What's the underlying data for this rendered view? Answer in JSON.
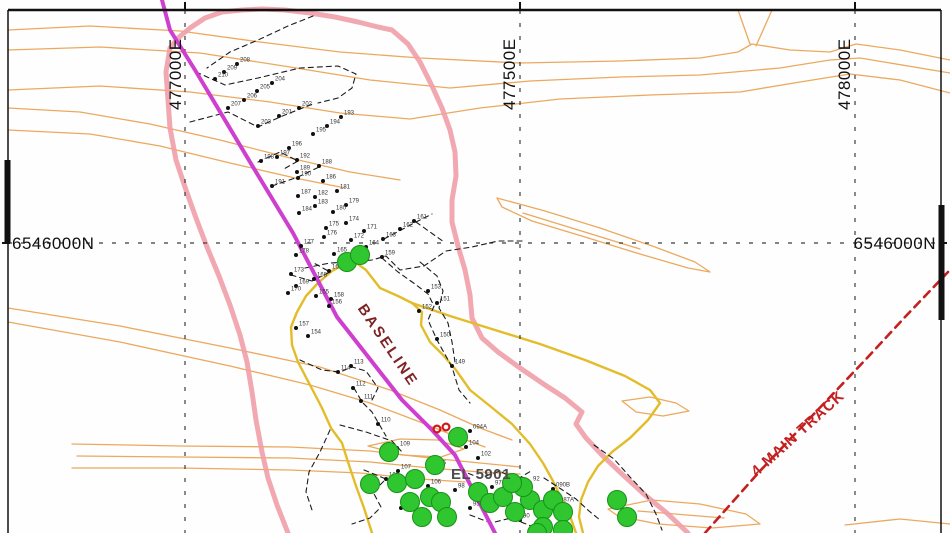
{
  "map": {
    "grid": {
      "eastings": [
        {
          "label": "477000E",
          "x": 185
        },
        {
          "label": "477500E",
          "x": 520
        },
        {
          "label": "478000E",
          "x": 855
        }
      ],
      "northings": [
        {
          "label": "6546000N",
          "y": 243
        }
      ],
      "northing_left_label": "6546000N",
      "northing_right_label": "6546000N",
      "line_color": "#3c3c3c"
    },
    "annotations": {
      "baseline_label": "BASELINE",
      "tenement_label": "EL 5901",
      "track_label": "4  MAIN TRACK"
    },
    "layers": {
      "contours": {
        "color": "#eba95f",
        "width": 1.3,
        "paths": [
          "M8,30 L90,26 L180,31 L260,42 L340,52 L420,58 L520,63 L620,61 L700,58 L738,52 L752,44 L790,50 L830,52 L856,44 L900,50 L950,60",
          "M738,10 L750,44",
          "M772,10 L756,46",
          "M8,50 L100,47 L200,53 L290,67 L370,80 L450,88 L530,81 L620,77 L700,75 L780,68 L830,60 L860,58 L950,73",
          "M8,90 L100,86 L190,92 L270,102 L340,113 L410,119 L480,108 L560,99 L650,95 L740,92 L800,82 L850,74 L900,80 L950,93",
          "M8,108 L80,112 L150,124 L220,140 L290,158 L350,172 L400,180",
          "M8,130 L90,134 L160,146 L230,163 L295,178 L345,188",
          "M8,308 L120,326 L230,348 L320,367 L390,390 L440,410 L480,428 L512,440",
          "M8,322 L120,342 L230,366 L310,385 L370,403 L420,422 L455,436 L485,447",
          "M72,444 L180,446 L290,447 L370,451 L430,458 L470,462 L520,467",
          "M77,456 L180,457 L290,458 L370,462 L430,468 L480,472 L520,474",
          "M72,468 L180,468 L290,470 L360,473 L420,479 L465,482",
          "M368,446 L400,439 L438,440 L464,449 L441,457 L402,455 Z",
          "M497,198 L545,211 L600,228 L655,247 L695,262 L710,272 L688,268 L640,254 L585,237 L532,221 L502,207 Z",
          "M523,213 L640,249",
          "M622,401 L650,397 L676,403 L689,411 L663,416 L636,412 Z",
          "M608,509 L652,500 L700,504 L746,514 L760,524 L712,528 L658,524 L618,516 Z",
          "M638,511 L724,518",
          "M845,525 L900,519 L950,524"
        ]
      },
      "pink_outline": {
        "color": "#ef9fa8",
        "width": 5,
        "paths": [
          "M288,533 L277,505 L268,478 L262,452 L256,420 L252,392 L247,362 L240,335 L230,305 L219,276 L207,247 L196,218 L186,190 L176,160 L170,128 L168,100 L166,72 L170,48 L178,38 L190,28 L205,18 L222,12 L242,10 L262,9 L285,10 L310,13 L335,17 L358,22 L378,27 L392,30 L408,44 L420,62 L432,86 L442,108 L450,130 L455,152 L456,176 L452,200 L452,222 L458,246 L465,270 L470,295 L472,318 L482,338 L498,352 L520,368 L545,385 L565,398 L582,412 L576,424 L586,438 L602,455 L622,474 L645,495 L668,514 L688,533"
        ]
      },
      "tenement": {
        "color": "#e3bc2a",
        "width": 2.4,
        "paths": [
          "M372,533 L364,508 L356,486 L348,462 L342,443 L331,428 L322,408 L310,385 L298,362 L292,345 L291,327 L297,312 L306,296 L318,283 L332,271 L345,264 L355,262 L366,270 L380,288 L398,296 L412,303 L422,312 L421,325 L430,342 L443,355 L456,370 L470,390 L490,406 L512,424 L530,444 L543,463 L553,481 L562,500 L570,516 L576,533",
          "M412,303 L450,316 L495,330 L540,344 L585,360 L625,376 L650,390 L660,403 L648,420 L630,438 L612,452 L598,466 L588,482 L581,500 L579,517 L583,533"
        ]
      },
      "baseline": {
        "color": "#cf3fcf",
        "width": 4,
        "paths": [
          "M162,0 L170,30 L195,70 L213,100 L253,167 L293,233 L337,317 L402,400 L432,430 L455,455 L495,533"
        ]
      },
      "track": {
        "color": "#c42020",
        "width": 2.6,
        "dash": "8 6",
        "paths": [
          "M705,533 L760,471 L812,416 L868,357 L905,317 L948,272"
        ]
      },
      "traverses": {
        "color": "#1c1c1c",
        "width": 1.1,
        "dash": "5 4",
        "paths": [
          "M313,16 L288,26 L258,40 L230,52 L207,68",
          "M196,72 L225,85 L258,78 L300,68 L338,66 L356,74 L352,88 L338,98 L318,103",
          "M190,122 L228,112 L258,127 L280,117 L300,109 L313,104",
          "M258,162 L280,152 L298,161 L282,170",
          "M272,186 L298,177 L319,167",
          "M305,268 L330,263 L352,262 L372,260 L386,256 L400,270 L424,266 L446,251 L472,247 L498,241 L524,241",
          "M384,239 L401,230 L416,222 L432,214",
          "M416,222 L444,242",
          "M382,258 L398,272 L415,284 L428,294 L434,306 L428,320 L437,340 L452,367 L459,390 L470,403",
          "M291,275 L312,281 L330,272 L312,262",
          "M300,360 L322,370 L340,372 L352,367 L366,371 L378,388 L372,400",
          "M354,388 L362,402 L372,412 L379,424 L386,436",
          "M330,430 L320,452 L309,472 L306,492 L312,510",
          "M340,425 L366,432 L392,441 L402,452",
          "M420,262 L437,276 L443,291 L439,308 L448,323 L452,342 L455,362",
          "M460,470 L480,478 L500,471 L516,480 L531,471",
          "M544,478 L561,489 L576,499 L589,511 L600,520",
          "M594,445 L614,459 L630,477 L646,494 L656,514 L662,530",
          "M470,515 L491,523 L511,518 L531,526 L549,532",
          "M364,470 L386,479 L373,492 L381,507 L370,518 L352,524"
        ]
      },
      "stations": {
        "dot_color": "#111111",
        "label_color": "#333333",
        "points": [
          {
            "id": "208",
            "x": 237,
            "y": 64
          },
          {
            "id": "209",
            "x": 224,
            "y": 72
          },
          {
            "id": "210",
            "x": 215,
            "y": 79
          },
          {
            "id": "204",
            "x": 272,
            "y": 83
          },
          {
            "id": "205",
            "x": 257,
            "y": 91
          },
          {
            "id": "206",
            "x": 244,
            "y": 100
          },
          {
            "id": "207",
            "x": 228,
            "y": 108
          },
          {
            "id": "202",
            "x": 299,
            "y": 108
          },
          {
            "id": "201",
            "x": 279,
            "y": 116
          },
          {
            "id": "203",
            "x": 258,
            "y": 126
          },
          {
            "id": "193",
            "x": 341,
            "y": 117
          },
          {
            "id": "194",
            "x": 327,
            "y": 126
          },
          {
            "id": "195",
            "x": 313,
            "y": 134
          },
          {
            "id": "196",
            "x": 289,
            "y": 148
          },
          {
            "id": "197",
            "x": 277,
            "y": 157
          },
          {
            "id": "198",
            "x": 261,
            "y": 161
          },
          {
            "id": "192",
            "x": 297,
            "y": 160
          },
          {
            "id": "188",
            "x": 319,
            "y": 166
          },
          {
            "id": "189",
            "x": 297,
            "y": 172
          },
          {
            "id": "190",
            "x": 298,
            "y": 178
          },
          {
            "id": "191",
            "x": 272,
            "y": 186
          },
          {
            "id": "186",
            "x": 323,
            "y": 181
          },
          {
            "id": "187",
            "x": 298,
            "y": 196
          },
          {
            "id": "182",
            "x": 315,
            "y": 197
          },
          {
            "id": "181",
            "x": 337,
            "y": 191
          },
          {
            "id": "183",
            "x": 315,
            "y": 206
          },
          {
            "id": "179",
            "x": 346,
            "y": 205
          },
          {
            "id": "184",
            "x": 299,
            "y": 213
          },
          {
            "id": "180",
            "x": 333,
            "y": 212
          },
          {
            "id": "174",
            "x": 346,
            "y": 223
          },
          {
            "id": "175",
            "x": 326,
            "y": 228
          },
          {
            "id": "171",
            "x": 364,
            "y": 231
          },
          {
            "id": "176",
            "x": 324,
            "y": 237
          },
          {
            "id": "172",
            "x": 351,
            "y": 240
          },
          {
            "id": "161",
            "x": 414,
            "y": 221
          },
          {
            "id": "162",
            "x": 400,
            "y": 229
          },
          {
            "id": "163",
            "x": 383,
            "y": 239
          },
          {
            "id": "164",
            "x": 366,
            "y": 247
          },
          {
            "id": "177",
            "x": 301,
            "y": 246
          },
          {
            "id": "178",
            "x": 296,
            "y": 255
          },
          {
            "id": "165",
            "x": 334,
            "y": 254
          },
          {
            "id": "159",
            "x": 382,
            "y": 257
          },
          {
            "id": "166",
            "x": 345,
            "y": 263
          },
          {
            "id": "167",
            "x": 329,
            "y": 271
          },
          {
            "id": "173",
            "x": 291,
            "y": 274
          },
          {
            "id": "168",
            "x": 314,
            "y": 279
          },
          {
            "id": "169",
            "x": 296,
            "y": 286
          },
          {
            "id": "170",
            "x": 288,
            "y": 293
          },
          {
            "id": "158",
            "x": 331,
            "y": 299
          },
          {
            "id": "156",
            "x": 329,
            "y": 306
          },
          {
            "id": "155",
            "x": 316,
            "y": 296
          },
          {
            "id": "157",
            "x": 296,
            "y": 328
          },
          {
            "id": "154",
            "x": 308,
            "y": 336
          },
          {
            "id": "153",
            "x": 428,
            "y": 291
          },
          {
            "id": "151",
            "x": 437,
            "y": 303
          },
          {
            "id": "152",
            "x": 419,
            "y": 311
          },
          {
            "id": "150",
            "x": 437,
            "y": 339
          },
          {
            "id": "149",
            "x": 452,
            "y": 366
          },
          {
            "id": "113",
            "x": 351,
            "y": 366
          },
          {
            "id": "114",
            "x": 338,
            "y": 372
          },
          {
            "id": "112",
            "x": 353,
            "y": 388
          },
          {
            "id": "111",
            "x": 361,
            "y": 401
          },
          {
            "id": "110",
            "x": 378,
            "y": 424
          },
          {
            "id": "109",
            "x": 397,
            "y": 448
          },
          {
            "id": "104",
            "x": 466,
            "y": 447
          },
          {
            "id": "102",
            "x": 478,
            "y": 458
          },
          {
            "id": "105",
            "x": 433,
            "y": 467
          },
          {
            "id": "107",
            "x": 398,
            "y": 471
          },
          {
            "id": "108",
            "x": 386,
            "y": 479
          },
          {
            "id": "106",
            "x": 428,
            "y": 486
          },
          {
            "id": "98",
            "x": 455,
            "y": 490
          },
          {
            "id": "99",
            "x": 428,
            "y": 497
          },
          {
            "id": "97",
            "x": 492,
            "y": 487
          },
          {
            "id": "93",
            "x": 499,
            "y": 492
          },
          {
            "id": "95",
            "x": 470,
            "y": 508
          },
          {
            "id": "103",
            "x": 401,
            "y": 508
          },
          {
            "id": "92",
            "x": 530,
            "y": 483
          },
          {
            "id": "94",
            "x": 512,
            "y": 513
          },
          {
            "id": "90",
            "x": 520,
            "y": 520
          },
          {
            "id": "090B",
            "x": 553,
            "y": 489
          },
          {
            "id": "087A",
            "x": 557,
            "y": 504
          },
          {
            "id": "094A",
            "x": 470,
            "y": 431
          }
        ]
      },
      "green_samples": {
        "fill": "#2fc62f",
        "stroke": "#169316",
        "radius": 9.5,
        "points": [
          [
            347,
            262
          ],
          [
            360,
            255
          ],
          [
            458,
            437
          ],
          [
            389,
            452
          ],
          [
            370,
            484
          ],
          [
            397,
            483
          ],
          [
            415,
            479
          ],
          [
            410,
            502
          ],
          [
            430,
            497
          ],
          [
            441,
            502
          ],
          [
            422,
            517
          ],
          [
            478,
            492
          ],
          [
            490,
            503
          ],
          [
            503,
            497
          ],
          [
            515,
            512
          ],
          [
            530,
            500
          ],
          [
            543,
            510
          ],
          [
            553,
            500
          ],
          [
            563,
            512
          ],
          [
            543,
            527
          ],
          [
            563,
            530
          ],
          [
            523,
            487
          ],
          [
            512,
            483
          ],
          [
            537,
            533
          ],
          [
            617,
            500
          ],
          [
            627,
            517
          ],
          [
            447,
            517
          ],
          [
            435,
            465
          ]
        ]
      },
      "red_samples": {
        "stroke": "#d01818",
        "radius": 3.4,
        "points": [
          [
            437,
            429
          ],
          [
            446,
            427
          ]
        ]
      }
    }
  }
}
